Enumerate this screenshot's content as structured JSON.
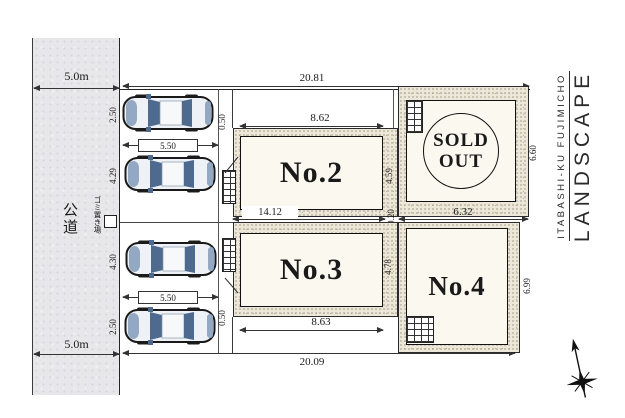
{
  "title": {
    "small": "ITABASHI-KU FUJIMICHO",
    "large": "LANDSCAPE"
  },
  "road": {
    "label": "公道",
    "dim_top": "5.0m",
    "dim_bottom": "5.0m"
  },
  "garbage_label": "ゴミ置き場",
  "dims": {
    "site_top": "20.81",
    "site_bottom": "20.09",
    "middle": "14.12",
    "gap": "0.20",
    "frontage": [
      "2.50",
      "4.29",
      "4.30",
      "2.50"
    ],
    "stall_top": "5.50",
    "stall_bottom": "5.50",
    "step_top": "0.50",
    "step_bottom": "0.50",
    "no2_width": "8.62",
    "no2_depth": "4.59",
    "no3_width": "8.63",
    "no3_depth": "4.78",
    "no4_width": "6.32",
    "no4_depth": "6.99",
    "sold_depth": "6.60"
  },
  "plots": {
    "no2": "No.2",
    "no3": "No.3",
    "no4": "No.4",
    "sold_line1": "SOLD",
    "sold_line2": "OUT"
  },
  "colors": {
    "stipple_band": "#ece7d8",
    "plot_fill": "#faf8ef",
    "road_fill": "#e7e7ea",
    "car_dark": "#4e6a8e",
    "car_mid": "#93a9c3",
    "car_light": "#eef2f6",
    "line": "#1a1a1a"
  }
}
